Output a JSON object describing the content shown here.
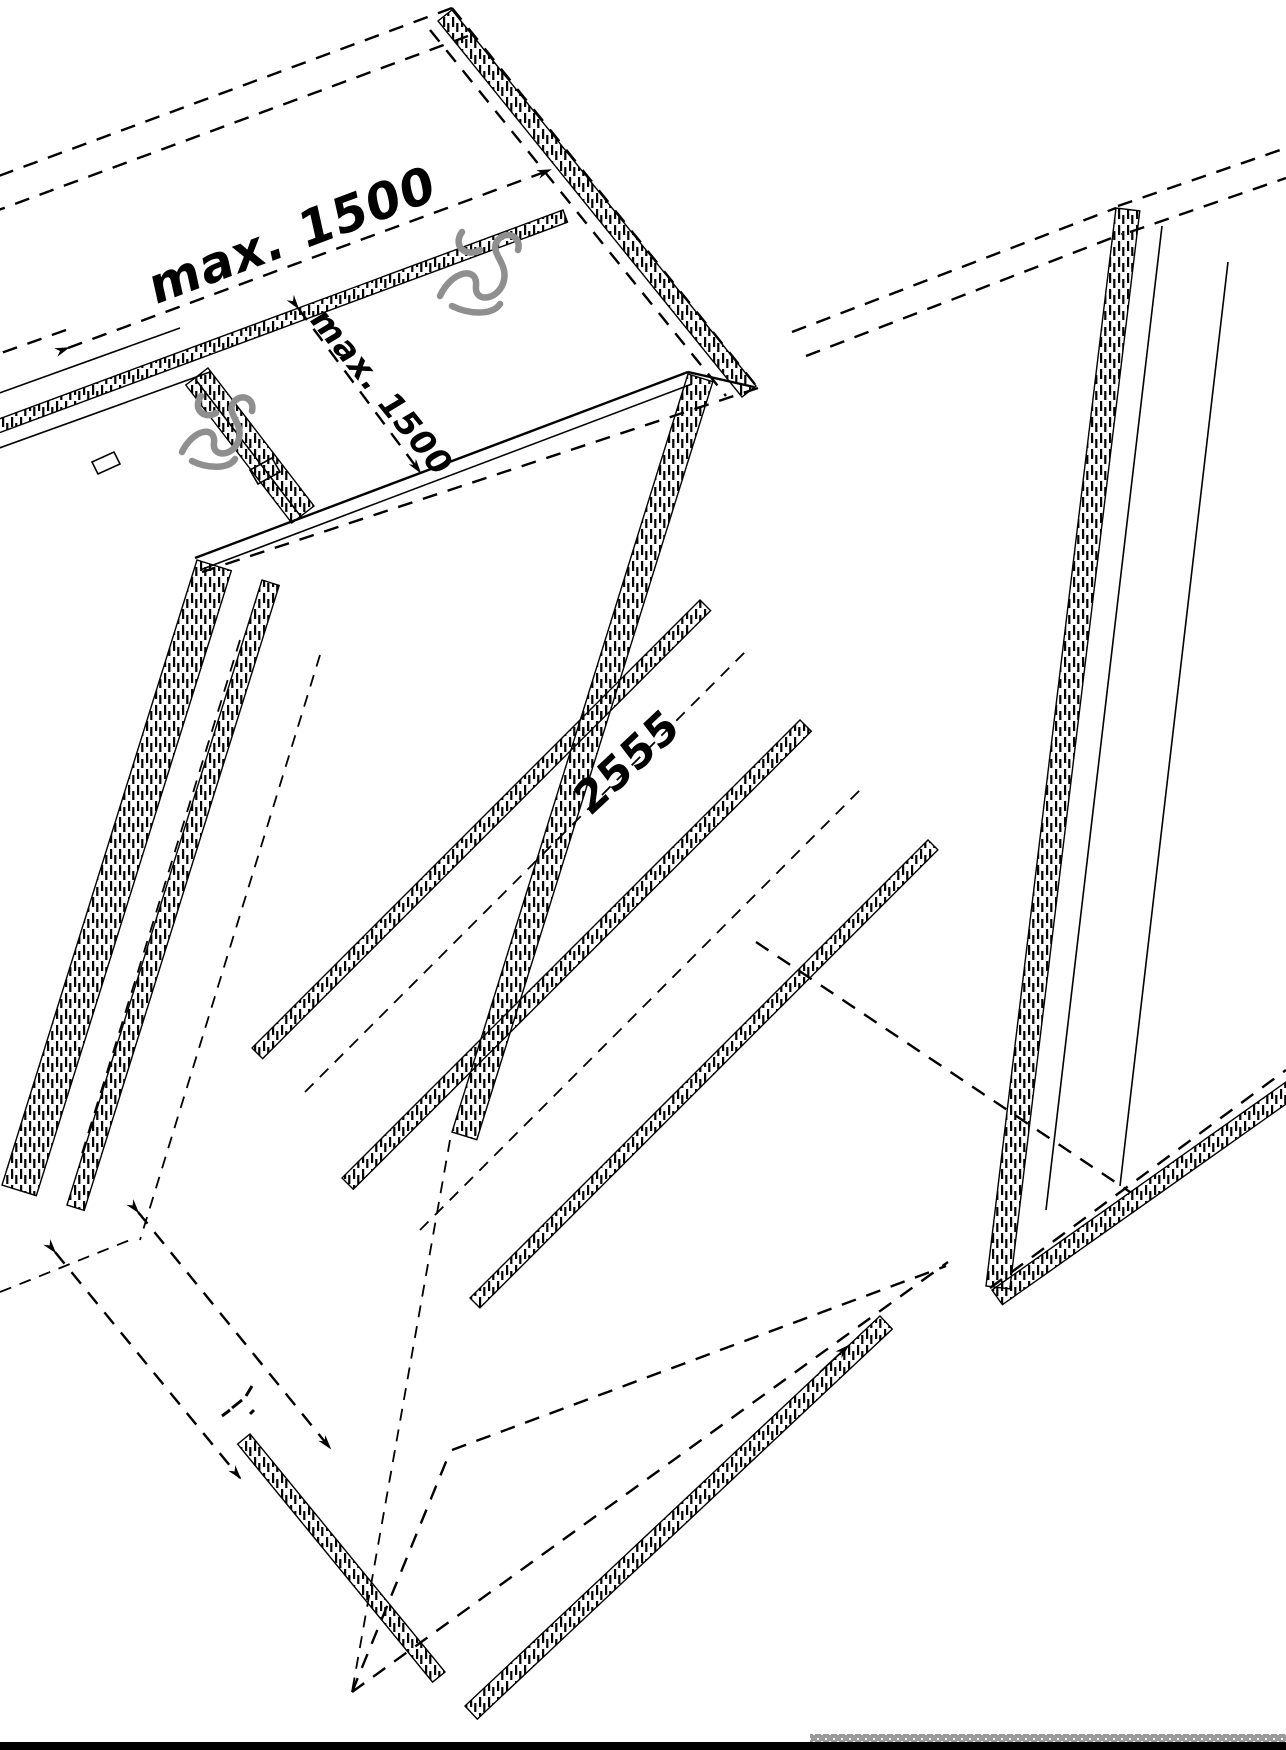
{
  "drawing": {
    "background": "#ffffff",
    "line_color": "#000000",
    "fixing_mark_color": "#8f8f8f",
    "footer_bar_color": "#000000",
    "footer_strip_color": "#9a9a9a",
    "labels": {
      "max_spacing_top": "max. 1500",
      "max_spacing_side": "max. 1500",
      "width_dimension": "2555"
    },
    "icons": {
      "fixing_mark_1": "screw-scribble-icon",
      "fixing_mark_2": "screw-scribble-icon",
      "arrowheads": "dimension-arrowhead-icon"
    }
  }
}
